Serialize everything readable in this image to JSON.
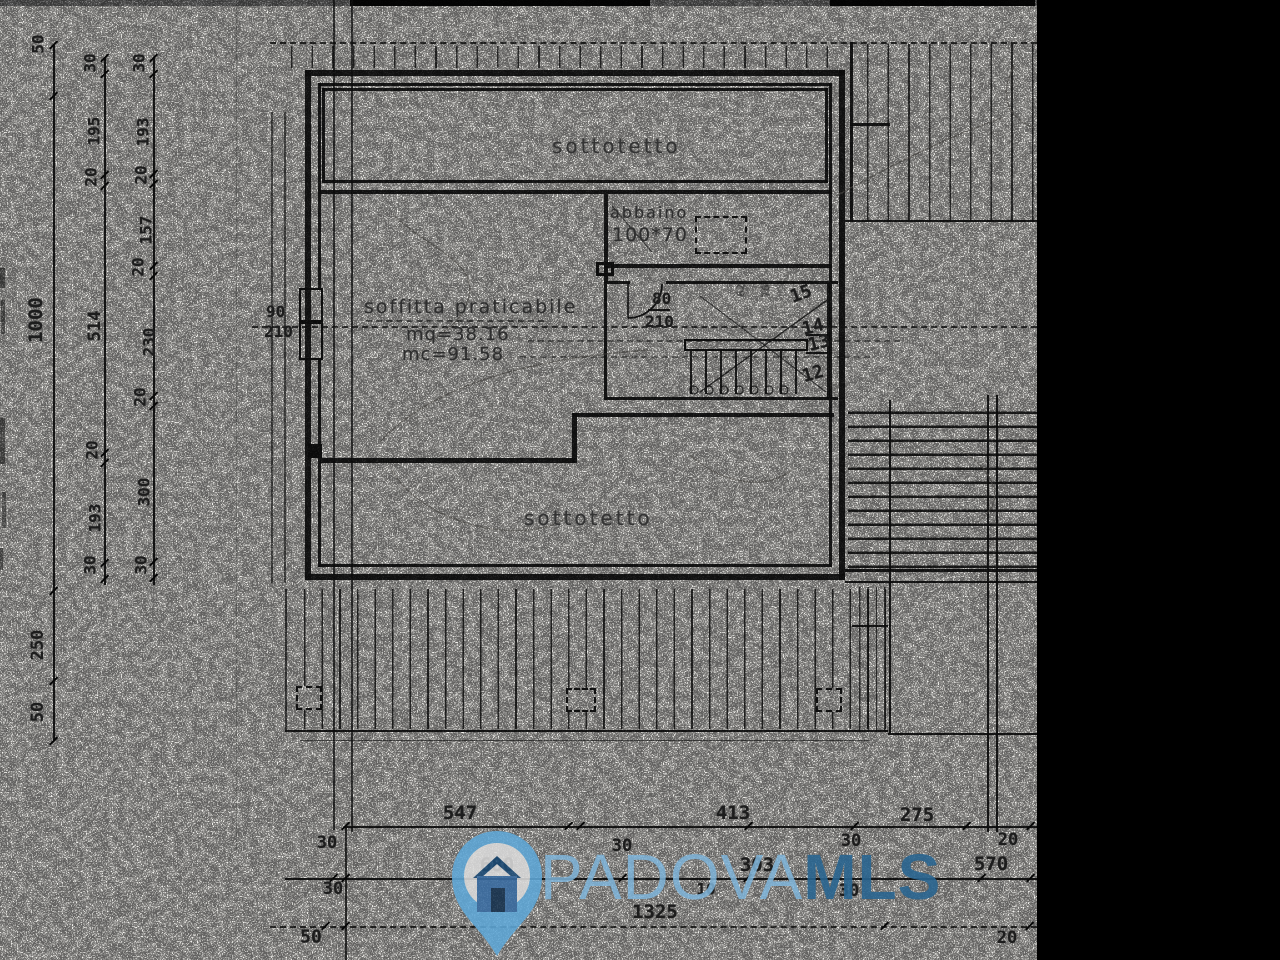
{
  "rooms": {
    "top_attic": "sottotetto",
    "loft": "soffitta praticabile",
    "loft_area": "mq=38.16",
    "loft_volume": "mc=91.58",
    "dormer": "abbaino",
    "dormer_size": "100*70",
    "bottom_attic": "sottotetto"
  },
  "openings": {
    "door_width": "80",
    "door_height": "210",
    "window_width": "90",
    "window_height": "210"
  },
  "stairs": {
    "steps": [
      {
        "text": "15",
        "x": 801,
        "y": 294,
        "rot": -20
      },
      {
        "text": "14",
        "x": 813,
        "y": 327,
        "rot": -14
      },
      {
        "text": "13",
        "x": 819,
        "y": 343,
        "rot": -14
      },
      {
        "text": "12",
        "x": 813,
        "y": 374,
        "rot": -16
      }
    ],
    "side_dims": [
      {
        "text": "62",
        "x": 741,
        "y": 290
      },
      {
        "text": "76",
        "x": 766,
        "y": 291
      }
    ]
  },
  "dimensions": {
    "left": [
      {
        "col": 1,
        "text": "50",
        "x": 38,
        "y": 44,
        "s": 16
      },
      {
        "col": 1,
        "text": "1000",
        "x": 36,
        "y": 320,
        "s": 19
      },
      {
        "col": 1,
        "text": "250",
        "x": 38,
        "y": 645,
        "s": 17
      },
      {
        "col": 1,
        "text": "50",
        "x": 38,
        "y": 712,
        "s": 17
      },
      {
        "col": 2,
        "text": "30",
        "x": 90,
        "y": 63,
        "s": 16
      },
      {
        "col": 2,
        "text": "195",
        "x": 94,
        "y": 131,
        "s": 16
      },
      {
        "col": 2,
        "text": "20",
        "x": 91,
        "y": 177,
        "s": 16
      },
      {
        "col": 2,
        "text": "514",
        "x": 95,
        "y": 326,
        "s": 17
      },
      {
        "col": 2,
        "text": "20",
        "x": 92,
        "y": 450,
        "s": 16
      },
      {
        "col": 2,
        "text": "193",
        "x": 95,
        "y": 518,
        "s": 16
      },
      {
        "col": 2,
        "text": "30",
        "x": 90,
        "y": 565,
        "s": 16
      },
      {
        "col": 3,
        "text": "30",
        "x": 139,
        "y": 63,
        "s": 16
      },
      {
        "col": 3,
        "text": "193",
        "x": 143,
        "y": 132,
        "s": 16
      },
      {
        "col": 3,
        "text": "20",
        "x": 141,
        "y": 175,
        "s": 16
      },
      {
        "col": 3,
        "text": "157",
        "x": 146,
        "y": 230,
        "s": 16
      },
      {
        "col": 3,
        "text": "20",
        "x": 138,
        "y": 267,
        "s": 16
      },
      {
        "col": 3,
        "text": "230",
        "x": 149,
        "y": 342,
        "s": 16
      },
      {
        "col": 3,
        "text": "20",
        "x": 140,
        "y": 397,
        "s": 16
      },
      {
        "col": 3,
        "text": "300",
        "x": 144,
        "y": 492,
        "s": 16
      },
      {
        "col": 3,
        "text": "30",
        "x": 141,
        "y": 565,
        "s": 16
      }
    ],
    "bottom": [
      {
        "text": "547",
        "x": 460,
        "y": 813,
        "s": 19
      },
      {
        "text": "413",
        "x": 733,
        "y": 813,
        "s": 19
      },
      {
        "text": "275",
        "x": 917,
        "y": 815,
        "s": 19
      },
      {
        "text": "30",
        "x": 327,
        "y": 843,
        "s": 17
      },
      {
        "text": "30",
        "x": 622,
        "y": 846,
        "s": 17
      },
      {
        "text": "30",
        "x": 851,
        "y": 841,
        "s": 17
      },
      {
        "text": "20",
        "x": 1008,
        "y": 840,
        "s": 17
      },
      {
        "text": "680",
        "x": 497,
        "y": 865,
        "s": 19
      },
      {
        "text": "303",
        "x": 757,
        "y": 865,
        "s": 19
      },
      {
        "text": "570",
        "x": 991,
        "y": 864,
        "s": 19
      },
      {
        "text": "10",
        "x": 706,
        "y": 889,
        "s": 16
      },
      {
        "text": "30",
        "x": 333,
        "y": 889,
        "s": 17
      },
      {
        "text": "30",
        "x": 849,
        "y": 891,
        "s": 17
      },
      {
        "text": "1325",
        "x": 655,
        "y": 912,
        "s": 19
      },
      {
        "text": "50",
        "x": 311,
        "y": 937,
        "s": 18
      },
      {
        "text": "20",
        "x": 1007,
        "y": 938,
        "s": 17
      }
    ]
  },
  "watermark": {
    "brand_light": "PADOVA",
    "brand_bold": "MLS",
    "colors": {
      "pin": "#5fa8d8",
      "pin_inner": "#dcdcdc",
      "house_roof": "#1e4d78",
      "house_body": "#3a6da3",
      "house_door": "#15314e",
      "text_light": "#7fb5da",
      "text_bold": "#296590"
    }
  }
}
